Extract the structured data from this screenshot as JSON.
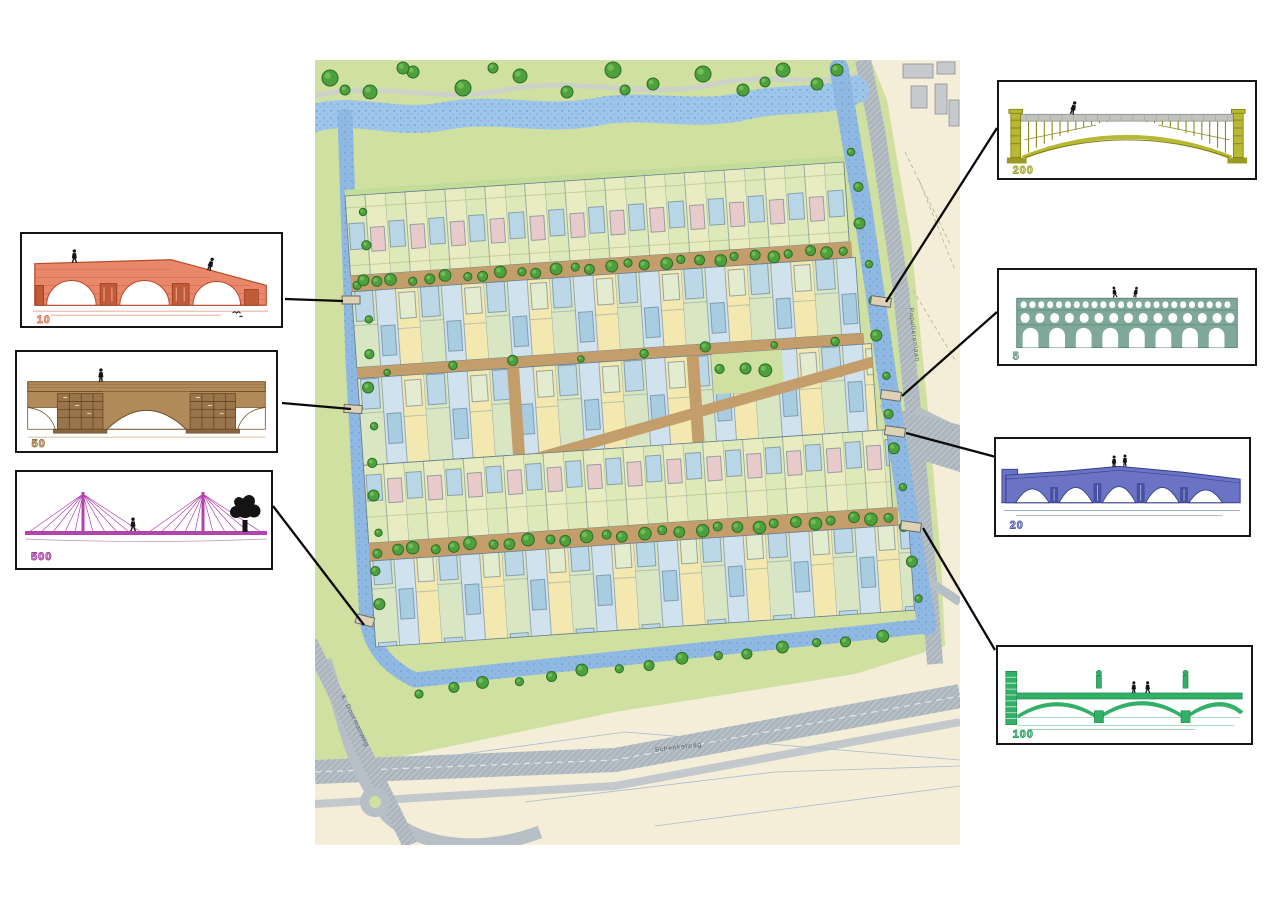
{
  "figure_type": "masterplan-with-bridge-callouts",
  "bridges": [
    {
      "id": "10",
      "label": "10",
      "color": "#e8876a",
      "style": "three-arch brick bridge",
      "people": 2,
      "extra": "bird"
    },
    {
      "id": "50",
      "label": "50",
      "color": "#b08a58",
      "style": "single-arch bridge with twin panelled piers",
      "people": 1
    },
    {
      "id": "500",
      "label": "500",
      "color": "#b344ae",
      "style": "cable-stayed bridge with two masts",
      "people": 1,
      "extra": "tree"
    },
    {
      "id": "200",
      "label": "200",
      "color": "#b8b832",
      "style": "steel lattice arch bridge",
      "people": 1
    },
    {
      "id": "5",
      "label": "5",
      "color": "#7fa898",
      "style": "three-tier arched aqueduct",
      "people": 2
    },
    {
      "id": "20",
      "label": "20",
      "color": "#6b74c4",
      "style": "five-arch bridge",
      "people": 2
    },
    {
      "id": "100",
      "label": "100",
      "color": "#33b068",
      "style": "three-arch bridge with statue piers",
      "people": 2
    }
  ],
  "map": {
    "street_labels": [
      {
        "id": "bottom-road",
        "text": "Schenkelweg"
      },
      {
        "id": "right-road",
        "text": "Populierenlaan"
      },
      {
        "id": "left-road",
        "text": "K. Doormanweg"
      }
    ],
    "colors": {
      "water": "#8fb9e2",
      "field": "#cfe0a0",
      "road": "#b6bec6",
      "avenue": "#c49e6a",
      "tree": "#4da03c",
      "plot_yellow": "#f2e8b0",
      "plot_blue": "#cfe2ee",
      "plot_green": "#dde9b8",
      "cream": "#f4eed8"
    }
  },
  "connectors": [
    {
      "bridge": "10",
      "from": [
        285,
        299
      ],
      "to": [
        343,
        301
      ]
    },
    {
      "bridge": "50",
      "from": [
        282,
        403
      ],
      "to": [
        351,
        409
      ]
    },
    {
      "bridge": "500",
      "from": [
        273,
        506
      ],
      "to": [
        364,
        625
      ]
    },
    {
      "bridge": "200",
      "from": [
        997,
        128
      ],
      "to": [
        886,
        302
      ]
    },
    {
      "bridge": "5",
      "from": [
        997,
        312
      ],
      "to": [
        902,
        396
      ]
    },
    {
      "bridge": "20",
      "from": [
        996,
        457
      ],
      "to": [
        906,
        433
      ]
    },
    {
      "bridge": "100",
      "from": [
        995,
        650
      ],
      "to": [
        923,
        528
      ]
    }
  ]
}
